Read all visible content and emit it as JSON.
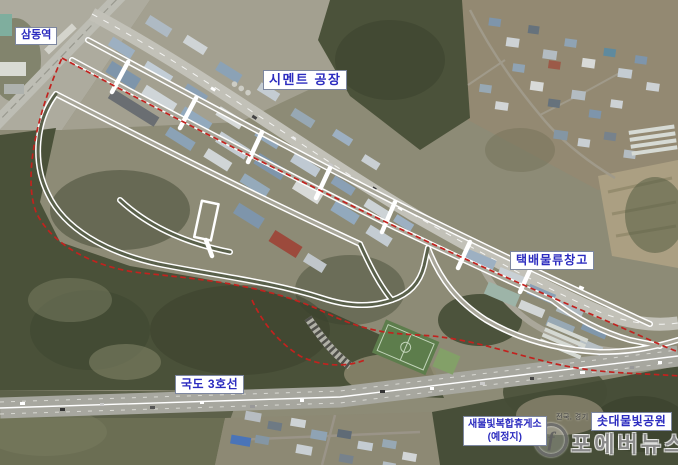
{
  "map_labels": {
    "samdong_station": "삼동역",
    "cement_factory": "시멘트 공장",
    "parcel_logistics_warehouse": "택배물류창고",
    "national_route_3": "국도 3호선",
    "rest_area_name": "새물빛복합휴게소",
    "rest_area_note": "(예정지)",
    "sotdae_mulbit_park": "솟대물빛공원"
  },
  "watermark": {
    "region_text": "전국, 경기",
    "brand_text": "포에버뉴스",
    "logo_letter": "f"
  },
  "colors": {
    "label_text": "#2b2bbf",
    "label_background": "#ffffff",
    "boundary_dashed_red": "#c2221e",
    "planned_road_white": "#ffffff",
    "watermark_gray": "#767676"
  }
}
